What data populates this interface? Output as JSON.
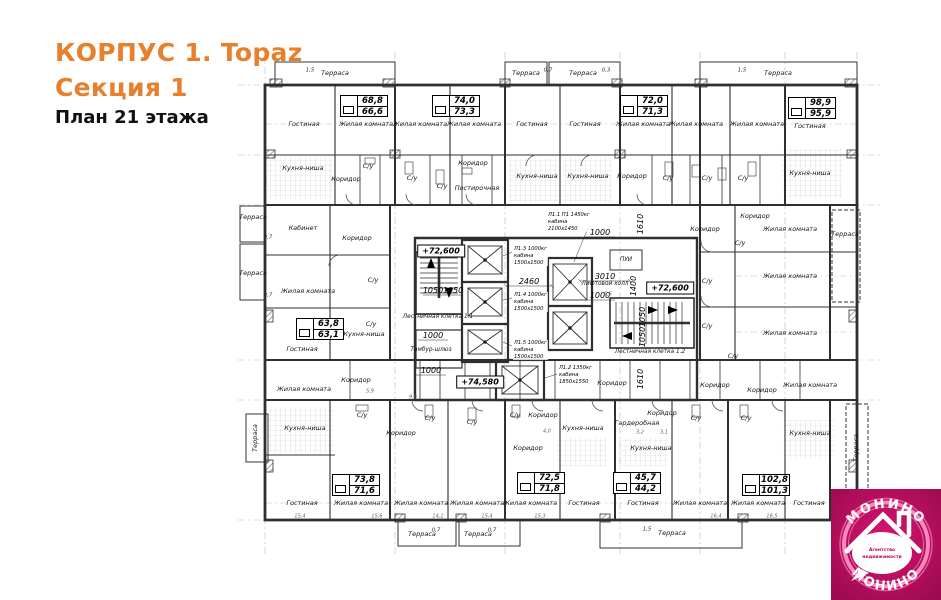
{
  "header": {
    "building": "КОРПУС 1. Topaz",
    "section": "Секция 1",
    "plan": "План 21 этажа"
  },
  "colors": {
    "accent": "#e87f2b",
    "logo_bg": "#c00f66",
    "logo_neon": "#ff8fc5",
    "wall": "#2f2f2f"
  },
  "levels": [
    "+72,600",
    "+74,580",
    "+72,600"
  ],
  "area_tables": [
    {
      "total": "68,8",
      "living": "66,6"
    },
    {
      "total": "74,0",
      "living": "73,3"
    },
    {
      "total": "72,0",
      "living": "71,3"
    },
    {
      "total": "98,9",
      "living": "95,9"
    },
    {
      "total": "63,8",
      "living": "63,1"
    },
    {
      "total": "73,8",
      "living": "71,6"
    },
    {
      "total": "72,5",
      "living": "71,8"
    },
    {
      "total": "45,7",
      "living": "44,2"
    },
    {
      "total": "102,8",
      "living": "101,3"
    }
  ],
  "rooms": [
    "Терраса",
    "Гостиная",
    "Жилая комната",
    "Жилая комната",
    "Жилая комната",
    "Терраса",
    "Терраса",
    "Гостиная",
    "Гостиная",
    "Жилая комната",
    "Жилая комната",
    "Терраса",
    "Жилая комната",
    "Гостиная",
    "Кухня-ниша",
    "Коридор",
    "С/у",
    "С/у",
    "Коридор",
    "С/у",
    "Постирочная",
    "Кухня-ниша",
    "Кухня-ниша",
    "Коридор",
    "С/у",
    "С/у",
    "С/у",
    "Кухня-ниша",
    "Терраса",
    "Терраса",
    "Кабинет",
    "Коридор",
    "Жилая комната",
    "С/у",
    "С/у",
    "Кухня-ниша",
    "Гостиная",
    "Коридор",
    "Коридор",
    "Жилая комната",
    "Терраса",
    "С/у",
    "Жилая комната",
    "С/у",
    "Жилая комната",
    "С/у",
    "С/у",
    "Жилая комната",
    "Коридор",
    "С/у",
    "Кухня-ниша",
    "Коридор",
    "С/у",
    "С/у",
    "Терраса",
    "Гостиная",
    "Жилая комната",
    "Жилая комната",
    "Жилая комната",
    "Терраса",
    "Терраса",
    "С/у",
    "Коридор",
    "Кухня-ниша",
    "Коридор",
    "Жилая комната",
    "Гостиная",
    "Терраса",
    "Гардеробная",
    "Коридор",
    "С/у",
    "Кухня-ниша",
    "Гостиная",
    "Жилая комната",
    "Коридор",
    "Коридор",
    "Коридор",
    "Жилая комната",
    "С/у",
    "Кухня-ниша",
    "Терраса",
    "Жилая комната",
    "Гостиная"
  ],
  "core": {
    "stair1": "Лестничная клетка 1.1",
    "stair2": "Лестничная клетка 1.2",
    "vestibule": "Тамбур-шлюз",
    "lift_hall": "Лифтовой холл",
    "pui": "ПУИ"
  },
  "elevators": [
    {
      "name": "Л1.3 1000кг",
      "l2": "кабина",
      "l3": "1500х1500"
    },
    {
      "name": "Л1.4 1000кг",
      "l2": "кабина",
      "l3": "1500х1500"
    },
    {
      "name": "Л1.5 1000кг",
      "l2": "кабина",
      "l3": "1500х1500"
    },
    {
      "name": "Л1.1 П1 1450кг",
      "l2": "кабина",
      "l3": "2100х1450"
    },
    {
      "name": "Л1.2 1350кг",
      "l2": "кабина",
      "l3": "1850х1550"
    }
  ],
  "dims": [
    "2460",
    "3010",
    "1000",
    "1000",
    "1050",
    "1050",
    "1000",
    "1000",
    "1610",
    "1400",
    "1610",
    "1050",
    "1050"
  ],
  "edge_dims": [
    "1,5",
    "0,7",
    "0,3",
    "1,5",
    "0,7",
    "0,7",
    "0,7",
    "0,7",
    "1,5"
  ],
  "small_dims": [
    "5,9",
    "9,9",
    "4,0",
    "3,2",
    "3,1",
    "5,5",
    "15,4",
    "15,6",
    "14,1",
    "15,4",
    "15,3",
    "16,4",
    "16,5"
  ],
  "logo": {
    "brand_top": "МОНИНО",
    "brand_bottom": "МОНИНО",
    "tagline1": "Агентство",
    "tagline2": "недвижимости"
  }
}
